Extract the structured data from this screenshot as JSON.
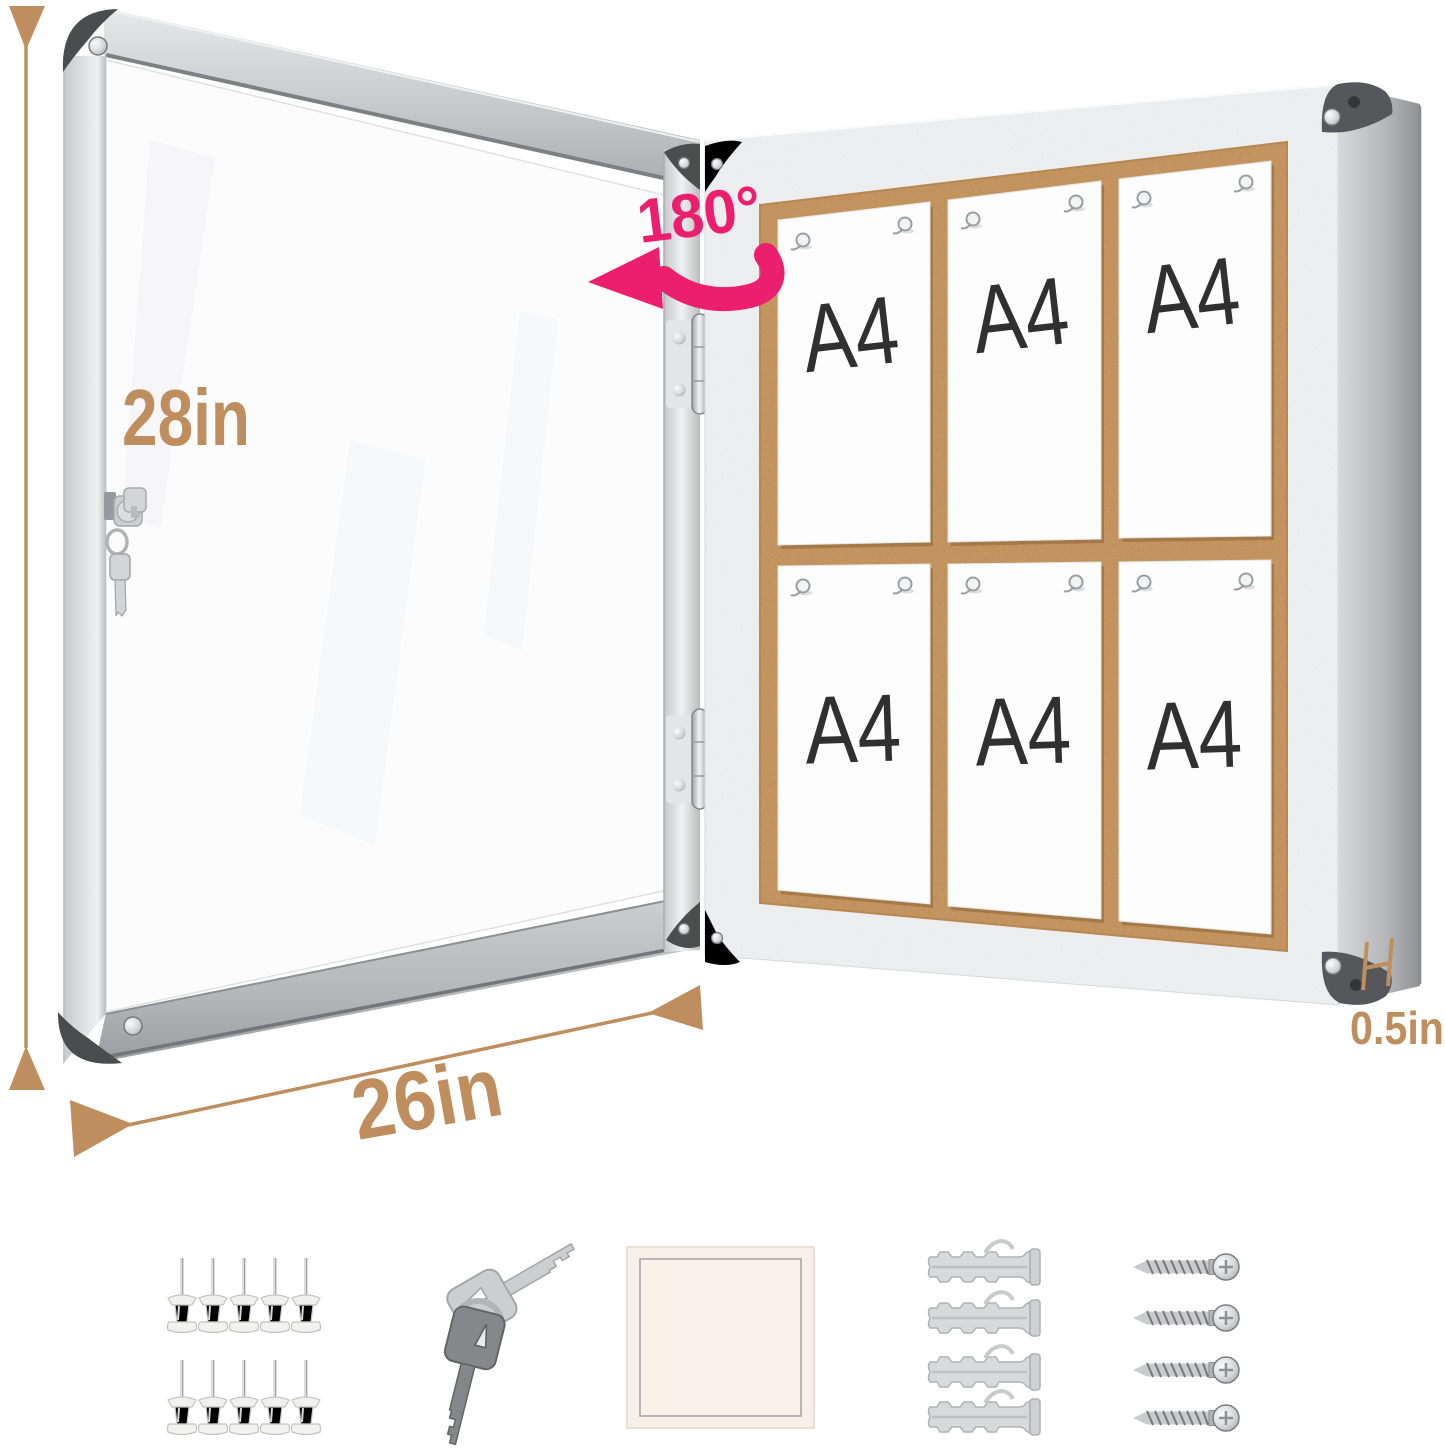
{
  "annotations": {
    "height_label": "28in",
    "width_label": "26in",
    "depth_label": "0.5in",
    "rotation_label": "180°",
    "dimension_color": "#be8e5e",
    "accent_color": "#ec1e6e"
  },
  "board": {
    "paper_label": "A4",
    "papers_count": 6,
    "grid": "2 rows x 3 columns",
    "cork_color": "#d09a62",
    "frame_color": "#d9dadb",
    "pins_per_paper": 2
  },
  "hardware": {
    "push_pins_count": 10,
    "keys_count": 2,
    "adhesive_pads_count": 1,
    "wall_anchors_count": 4,
    "screws_count": 4
  }
}
